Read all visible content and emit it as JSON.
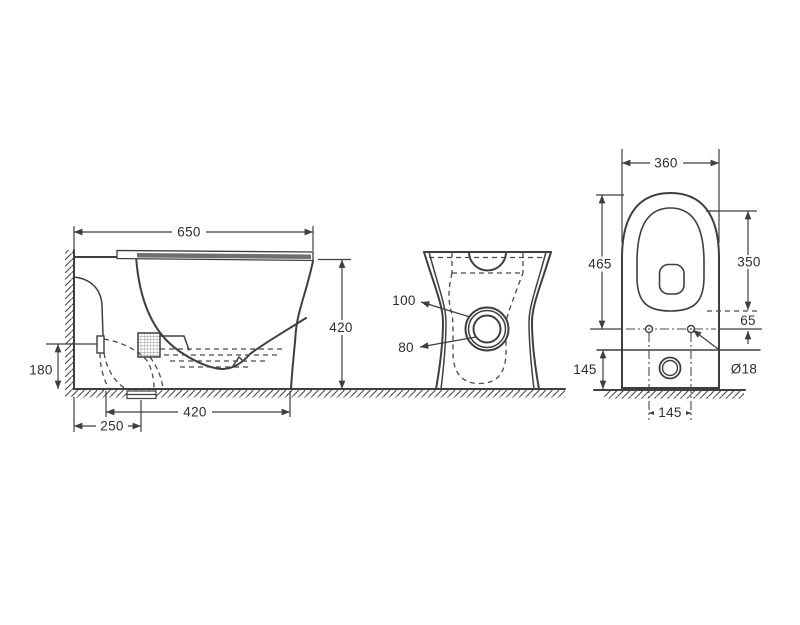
{
  "drawing_type": "toilet-pan-technical-drawing",
  "colors": {
    "line": "#3f3f3f",
    "text": "#2e2e2e",
    "seat_lid_fill": "#6f6f6f",
    "background": "#ffffff"
  },
  "views": {
    "side": {
      "overall_depth": "650",
      "seat_height": "420",
      "inlet_height": "180",
      "outlet_to_front": "420",
      "wall_to_outlet": "250"
    },
    "rear": {
      "inlet_outer": "100",
      "inlet_inner": "80"
    },
    "plan": {
      "overall_width": "360",
      "overall_length": "465",
      "seat_length": "350",
      "seat_to_holes": "65",
      "back_depth": "145",
      "hole_spacing": "145",
      "hole_diameter": "Ø18"
    }
  }
}
